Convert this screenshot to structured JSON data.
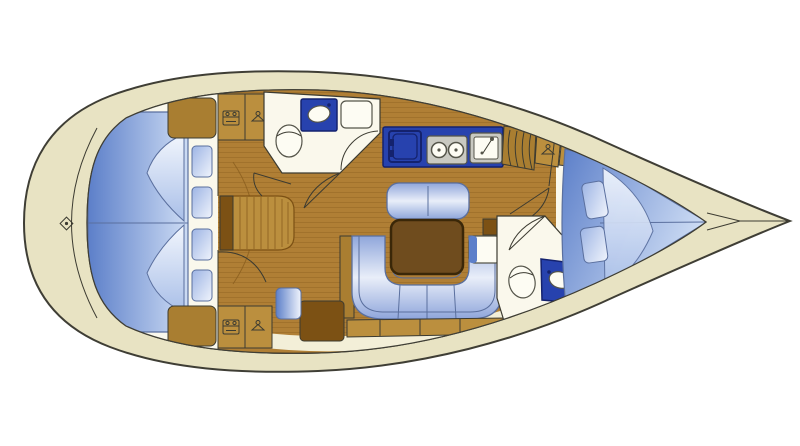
{
  "diagram": {
    "type": "yacht-interior-floor-plan",
    "view": "top-down",
    "bow_direction": "right",
    "visible_text": [],
    "rooms": [
      {
        "name": "aft-double-berth-cabin",
        "position": "stern-left",
        "fixtures": [
          "double-berth-mattress",
          "center-seam",
          "folded-sheet-x2",
          "pillow-x4",
          "corner-locker-x2"
        ]
      },
      {
        "name": "aft-head",
        "position": "port-mid-left",
        "fixtures": [
          "toilet",
          "washbasin-counter",
          "vanity-seat",
          "door-arc"
        ]
      },
      {
        "name": "salon",
        "position": "center",
        "fixtures": [
          "u-shaped-settee",
          "side-bench",
          "fixed-table",
          "side-console",
          "step-block",
          "seat-box"
        ]
      },
      {
        "name": "galley",
        "position": "center-top",
        "fixtures": [
          "icebox",
          "two-burner-stove",
          "sink-with-faucet"
        ]
      },
      {
        "name": "nav-corner",
        "position": "center-bottom-left",
        "fixtures": [
          "chart-cabinet",
          "nav-seat"
        ]
      },
      {
        "name": "companionway",
        "position": "center-left",
        "fixtures": [
          "steps",
          "door-arc-x2"
        ]
      },
      {
        "name": "forward-head",
        "position": "starboard-mid-right",
        "fixtures": [
          "toilet",
          "washbasin-counter",
          "door-arc"
        ]
      },
      {
        "name": "fore-v-berth-cabin",
        "position": "bow-right",
        "fixtures": [
          "v-berth-mattress",
          "center-seam",
          "folded-sheet",
          "pillow-x2",
          "shelf-box-rows",
          "wardrobe-louvered",
          "hanging-locker",
          "shelf-locker"
        ]
      }
    ],
    "icons": [
      "shelf-icon",
      "hanger-icon",
      "glass-rack-icon",
      "windlass-diamond-icon",
      "burner-icon",
      "faucet-icon"
    ],
    "counts": {
      "aft_cabin_pillows": 4,
      "fore_cabin_pillows": 2,
      "stove_burners": 2
    }
  },
  "colors": {
    "background": "#ffffff",
    "hull_deck": "#e8e3c3",
    "hull_line": "#3f3e35",
    "deck_inner": "#f3efd8",
    "room_white": "#faf8ec",
    "wood_floor": "#b07f35",
    "wood_plank": "#8a5e1e",
    "cabinet_wood": "#a97e31",
    "cabinet_wood_light": "#bb8f3e",
    "wood_dark": "#7c5114",
    "table_brown": "#6f4c1e",
    "table_outline": "#3a2708",
    "counter_blue": "#2742ae",
    "counter_blue_dark": "#14226e",
    "mattress_blue": "#5c7fc9",
    "mattress_light": "#cddcf4",
    "settee_blue": "#8fa6db",
    "settee_light": "#e9eef9",
    "pillow_blue": "#9db4e4",
    "pillow_light": "#f0f4fc",
    "fold_light": "#f2f6fd",
    "fold_blue": "#a9bfe8",
    "upholstery_line": "#5a6f9e",
    "steel_gray": "#c9c9c1",
    "steel_dark": "#55554a",
    "fixture_white": "#fdfcf3",
    "line_dark": "#3c3b31"
  }
}
